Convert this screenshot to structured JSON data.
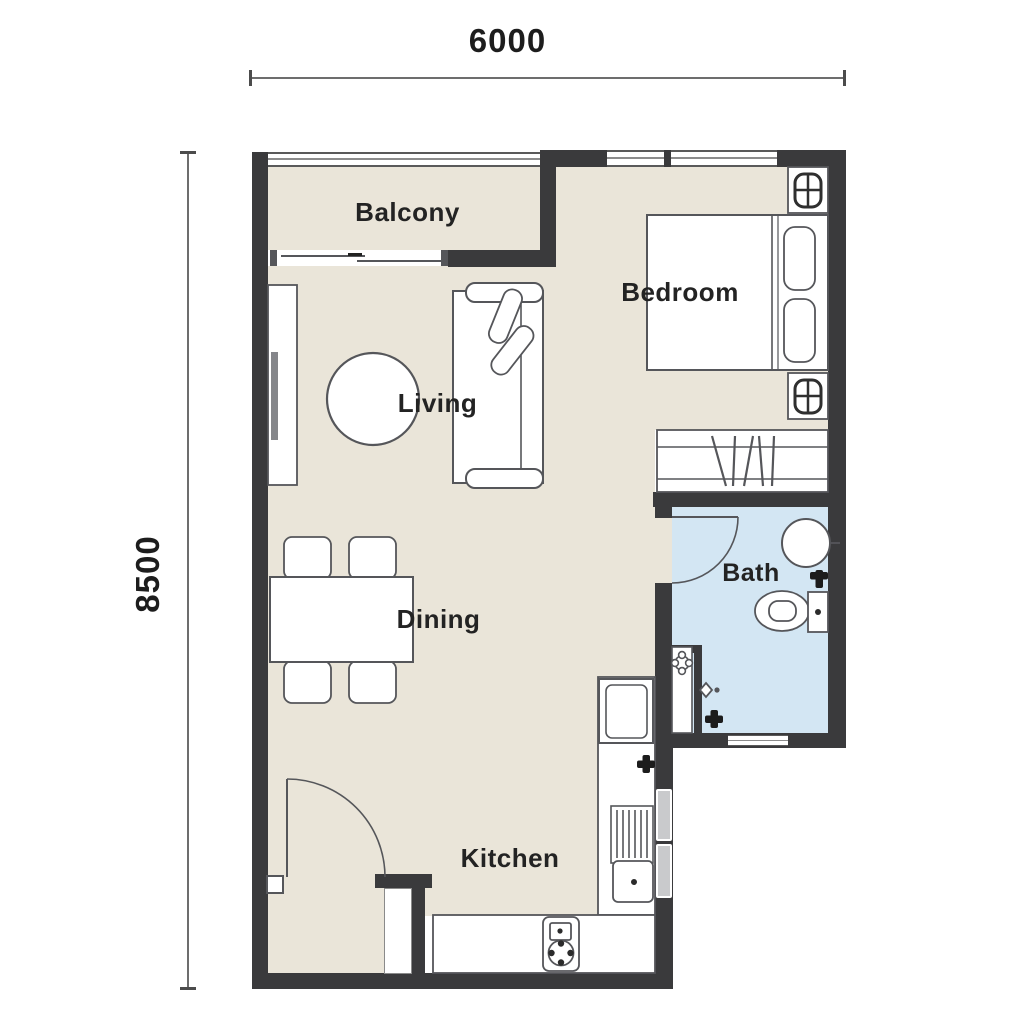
{
  "plan": {
    "type": "apartment-floor-plan",
    "dimensions": {
      "width_label": "6000",
      "height_label": "8500"
    },
    "rooms": {
      "balcony": {
        "label": "Balcony"
      },
      "bedroom": {
        "label": "Bedroom"
      },
      "living": {
        "label": "Living"
      },
      "dining": {
        "label": "Dining"
      },
      "bath": {
        "label": "Bath"
      },
      "kitchen": {
        "label": "Kitchen"
      }
    },
    "colors": {
      "wall": "#3a3a3c",
      "floor": "#eae5d9",
      "bath_floor": "#d3e6f3",
      "furniture_outline": "#55565a",
      "counter": "#ffffff",
      "vent": "#c9cacc",
      "dimension_line": "#6d6d6d",
      "text": "#232323"
    },
    "furniture_icons": [
      "double-bed",
      "pillow",
      "nightstand-lamp",
      "wardrobe-hangers",
      "sofa",
      "sofa-cushions",
      "round-coffee-table",
      "tv-console",
      "dining-table",
      "dining-chair",
      "toilet",
      "wash-basin",
      "shower-mixer",
      "floor-drain",
      "water-point",
      "fridge",
      "dish-rack",
      "kitchen-sink",
      "gas-cooktop",
      "entry-door-swing",
      "bath-door-swing",
      "sliding-door",
      "window",
      "balcony-railing"
    ]
  }
}
